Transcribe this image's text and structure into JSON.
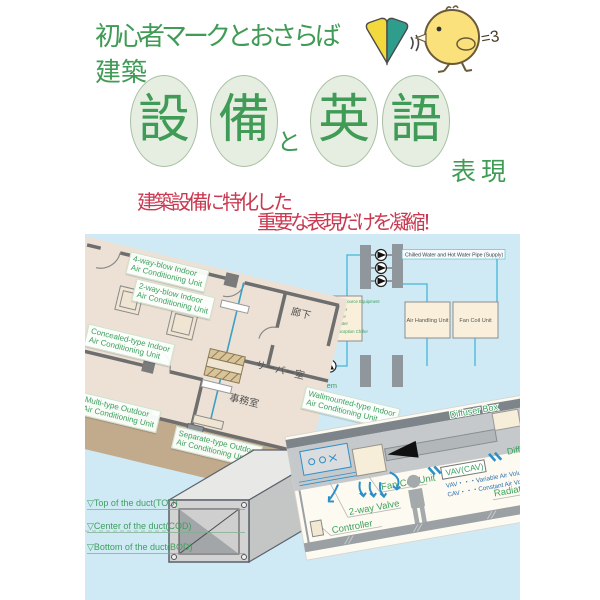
{
  "header": {
    "tagline": "初心者マークとおさらば",
    "title_prefix": "建築",
    "char1": "設",
    "char2": "備",
    "connector": "と",
    "char3": "英",
    "char4": "語",
    "suffix": "表現",
    "subtitle_line1": "建築設備に特化した",
    "subtitle_line2": "重要な表現だけを凝縮！",
    "chick_puff": "=3"
  },
  "floor_plan": {
    "labels": [
      {
        "l1": "4-way-blow Indoor",
        "l2": "Air Conditioning Unit"
      },
      {
        "l1": "2-way-blow Indoor",
        "l2": "Air Conditioning Unit"
      },
      {
        "l1": "Concealed-type Indoor",
        "l2": "Air Conditioning Unit"
      },
      {
        "l1": "Wallmounted-type Indoor",
        "l2": "Air Conditioning Unit"
      },
      {
        "l1": "Multi-type Outdoor",
        "l2": "Air Conditioning Unit"
      },
      {
        "l1": "Separate-type Outdoor",
        "l2": "Air Conditioning Unit"
      }
    ],
    "rooms": {
      "corridor": "廊下",
      "server_room": "サーバー室",
      "office": "事務室"
    }
  },
  "piping": {
    "supply_label": "Chilled Water and Hot Water Pipe (Supply)",
    "equipment_lines": [
      "Heat Source Equipment",
      "Chiller",
      "Boiler",
      "Heater",
      "Absorption Chiller"
    ],
    "ahu": "Air Handling Unit",
    "fcu": "Fan Coil Unit",
    "system": "System"
  },
  "section": {
    "diffuser_box": "Diffuser Box",
    "vav_cav": "VAV(CAV)",
    "diffuser": "Diffuser",
    "vav_def": "VAV・・・Variable Air Volume",
    "cav_def": "CAV・・・Constant Air Volume",
    "fan_coil": "Fan Coil Unit",
    "two_way_valve": "2-way Valve",
    "controller": "Controller",
    "radiator": "Radiator"
  },
  "duct": {
    "tod": "▽Top of the duct(TOD)",
    "cod": "▽Center of the duct(COD)",
    "bod": "▽Bottom of the duct(BOD)"
  },
  "colors": {
    "title_green": "#3f9b55",
    "subtitle_red": "#c93a52",
    "background_blue": "#cfe9f5",
    "label_green": "#3da05e",
    "pipe_cyan": "#45b6d6",
    "box_beige": "#f9efdb",
    "balcony_brown": "#c2aa8d",
    "floor_beige": "#ece1d4"
  }
}
